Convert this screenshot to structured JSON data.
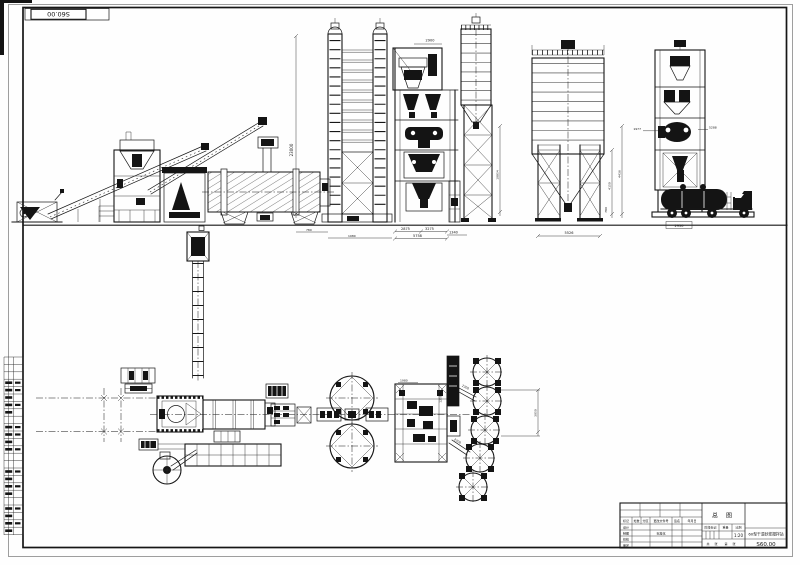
{
  "page": {
    "corner_label": "S60.00"
  },
  "title_block": {
    "title": "总  图",
    "product": "60型干混砂浆搅拌站",
    "drawing_no": "S60.00",
    "scale": "1:20",
    "header_labels": [
      "标记",
      "处数",
      "分区",
      "更改文件号",
      "签名",
      "年月日"
    ],
    "row_labels": [
      "设计",
      "制图",
      "校核",
      "审定"
    ],
    "std_label": "标准化",
    "stage_labels": [
      "阶段标记",
      "重量",
      "比例"
    ],
    "sheet_labels": [
      "共",
      "张",
      "第",
      "张"
    ]
  },
  "dims": {
    "tower_height": "23000",
    "hopper_top": "2900",
    "mix_a": "2875",
    "mix_b": "3275",
    "mix_total": "5758",
    "mix_off": "1340",
    "base_a": "780",
    "base_b": "1980",
    "silo_small_h": "10854",
    "silo_big_w": "5526",
    "leg_a": "4150",
    "leg_b": "4436",
    "leg_c": "780",
    "pack_l": "1977",
    "pack_r": "5288",
    "truck_w": "2950",
    "plan_top": "1980",
    "plan_shaft": "12584",
    "conv_a": "2200",
    "conv_b": "2200",
    "silo_pitch": "3050"
  }
}
